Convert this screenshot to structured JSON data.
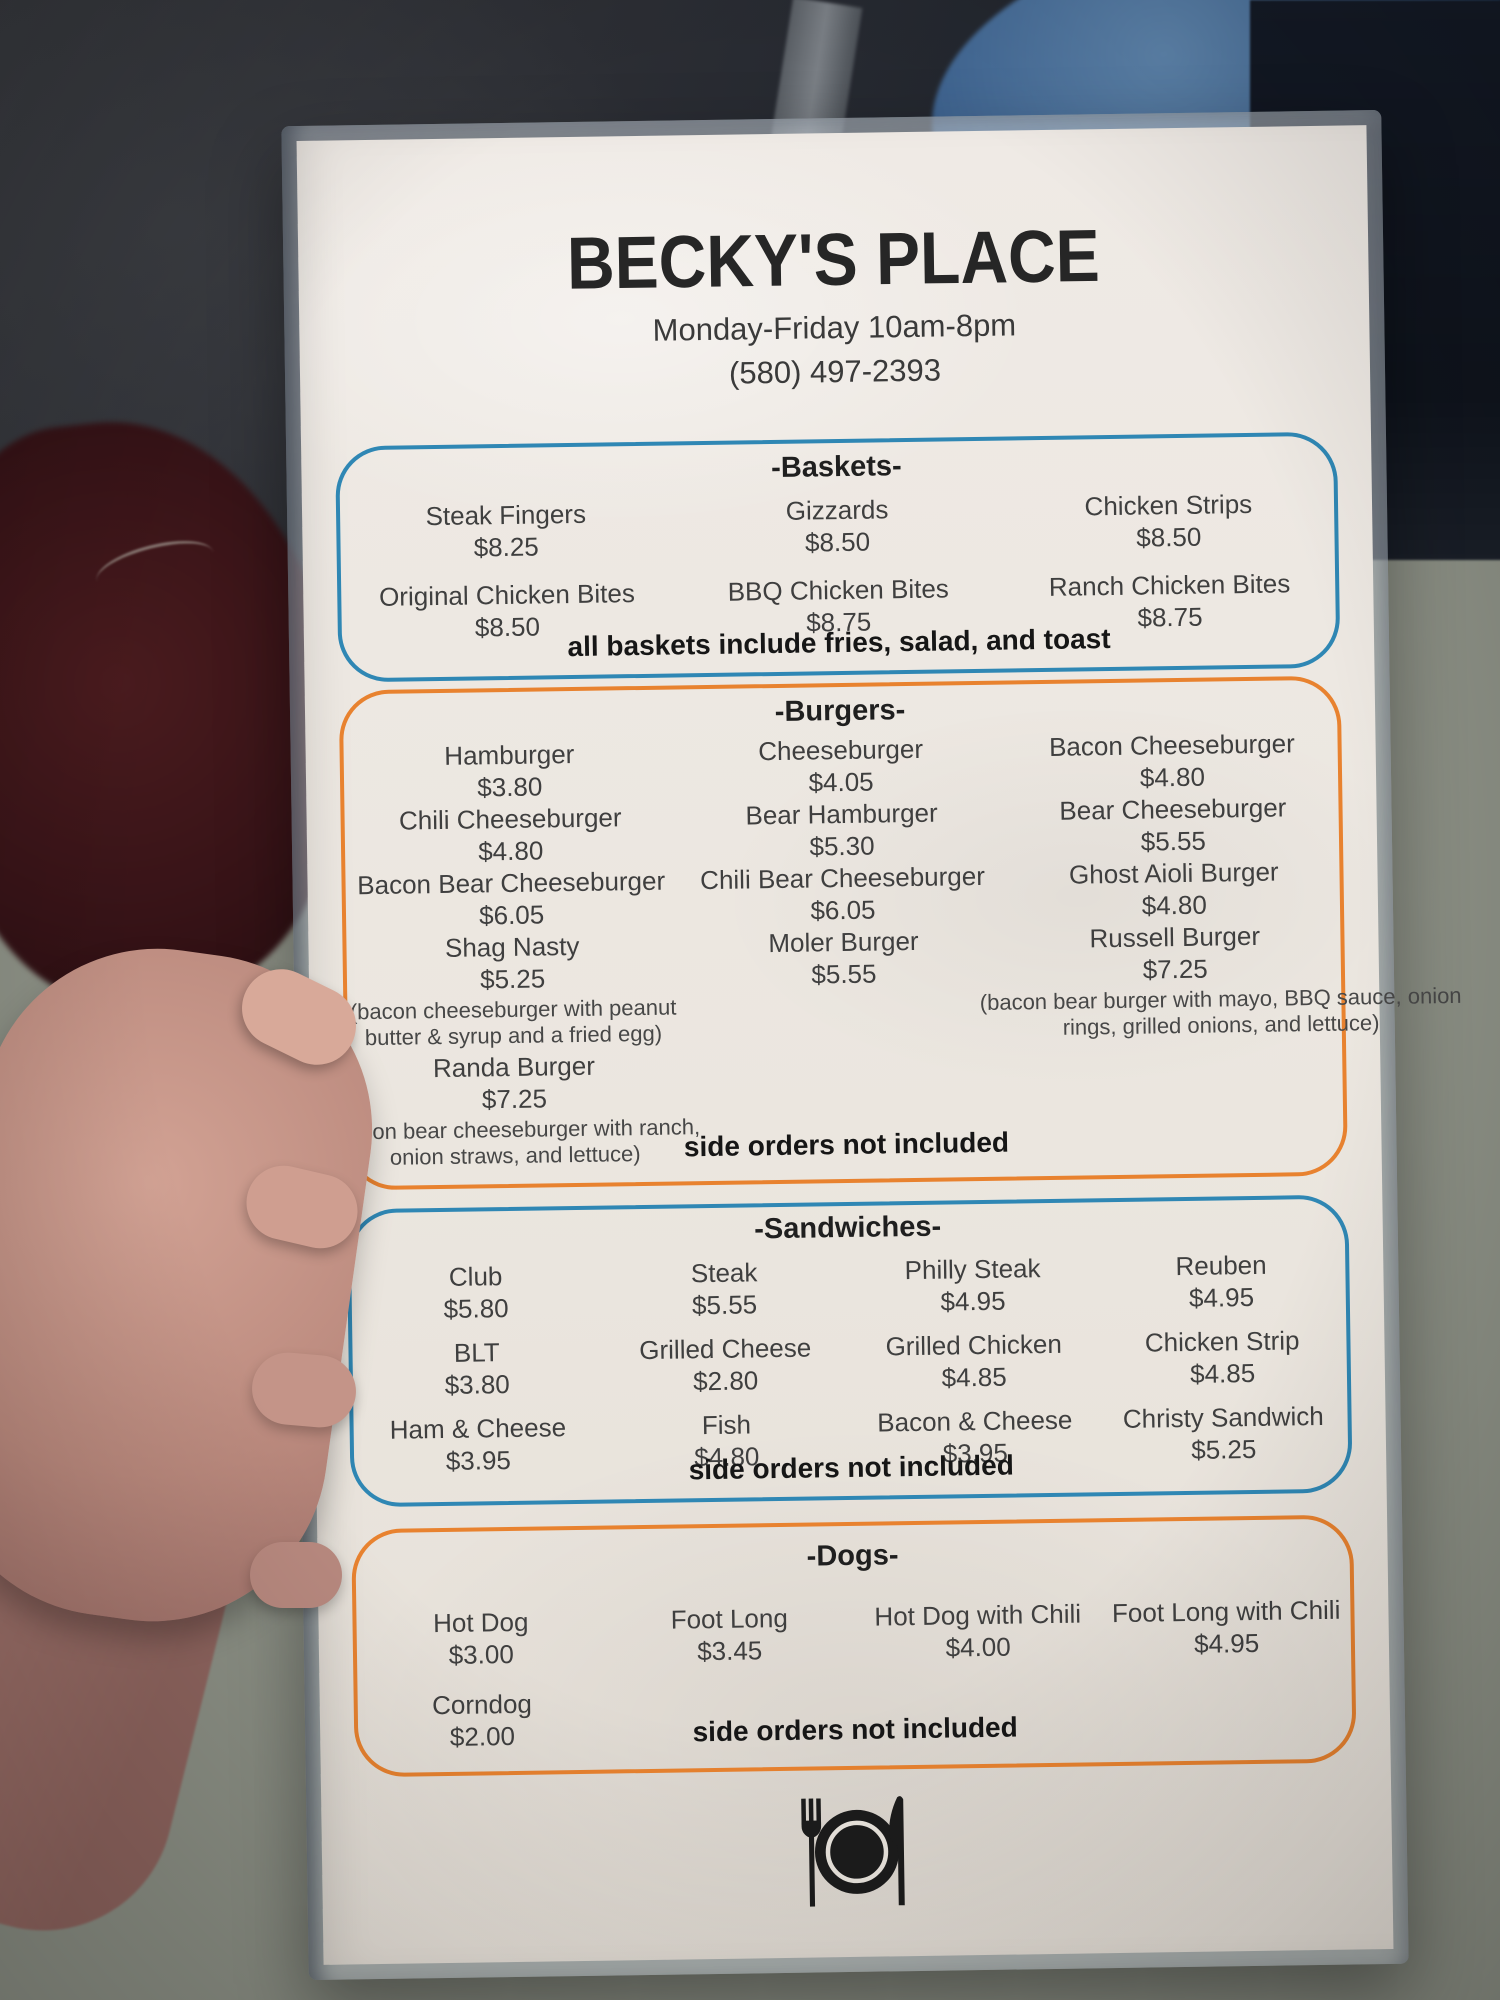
{
  "header": {
    "title": "BECKY'S PLACE",
    "hours": "Monday-Friday 10am-8pm",
    "phone": "(580) 497-2393"
  },
  "colors": {
    "section_blue": "#2f87b4",
    "section_orange": "#e8822f",
    "paper": "#ebe6df",
    "ink": "#3f3f3f"
  },
  "baskets": {
    "header": "-Baskets-",
    "items": [
      {
        "name": "Steak Fingers",
        "price": "$8.25"
      },
      {
        "name": "Gizzards",
        "price": "$8.50"
      },
      {
        "name": "Chicken Strips",
        "price": "$8.50"
      },
      {
        "name": "Original Chicken Bites",
        "price": "$8.50"
      },
      {
        "name": "BBQ Chicken Bites",
        "price": "$8.75"
      },
      {
        "name": "Ranch Chicken Bites",
        "price": "$8.75"
      }
    ],
    "note": "all baskets include fries, salad, and toast"
  },
  "burgers": {
    "header": "-Burgers-",
    "items": [
      {
        "name": "Hamburger",
        "price": "$3.80"
      },
      {
        "name": "Cheeseburger",
        "price": "$4.05"
      },
      {
        "name": "Bacon Cheeseburger",
        "price": "$4.80"
      },
      {
        "name": "Chili Cheeseburger",
        "price": "$4.80"
      },
      {
        "name": "Bear Hamburger",
        "price": "$5.30"
      },
      {
        "name": "Bear Cheeseburger",
        "price": "$5.55"
      },
      {
        "name": "Bacon Bear Cheeseburger",
        "price": "$6.05"
      },
      {
        "name": "Chili Bear Cheeseburger",
        "price": "$6.05"
      },
      {
        "name": "Ghost Aioli Burger",
        "price": "$4.80"
      },
      {
        "name": "Shag Nasty",
        "price": "$5.25",
        "desc": "(bacon cheeseburger with peanut butter & syrup and a fried egg)"
      },
      {
        "name": "Moler Burger",
        "price": "$5.55"
      },
      {
        "name": "Russell Burger",
        "price": "$7.25",
        "desc": "(bacon bear burger with mayo, BBQ sauce, onion rings, grilled onions, and lettuce)"
      },
      {
        "name": "Randa Burger",
        "price": "$7.25",
        "desc": "(bacon bear cheeseburger with ranch, onion straws, and lettuce)"
      }
    ],
    "note": "side orders not included"
  },
  "sandwiches": {
    "header": "-Sandwiches-",
    "items": [
      {
        "name": "Club",
        "price": "$5.80"
      },
      {
        "name": "Steak",
        "price": "$5.55"
      },
      {
        "name": "Philly Steak",
        "price": "$4.95"
      },
      {
        "name": "Reuben",
        "price": "$4.95"
      },
      {
        "name": "BLT",
        "price": "$3.80"
      },
      {
        "name": "Grilled Cheese",
        "price": "$2.80"
      },
      {
        "name": "Grilled Chicken",
        "price": "$4.85"
      },
      {
        "name": "Chicken Strip",
        "price": "$4.85"
      },
      {
        "name": "Ham & Cheese",
        "price": "$3.95"
      },
      {
        "name": "Fish",
        "price": "$4.80"
      },
      {
        "name": "Bacon & Cheese",
        "price": "$3.95"
      },
      {
        "name": "Christy Sandwich",
        "price": "$5.25"
      }
    ],
    "note": "side orders not included"
  },
  "dogs": {
    "header": "-Dogs-",
    "items": [
      {
        "name": "Hot Dog",
        "price": "$3.00"
      },
      {
        "name": "Foot Long",
        "price": "$3.45"
      },
      {
        "name": "Hot Dog with Chili",
        "price": "$4.00"
      },
      {
        "name": "Foot Long with Chili",
        "price": "$4.95"
      },
      {
        "name": "Corndog",
        "price": "$2.00"
      }
    ],
    "note": "side orders not included"
  },
  "footer": {
    "icon": "place-setting-icon"
  }
}
